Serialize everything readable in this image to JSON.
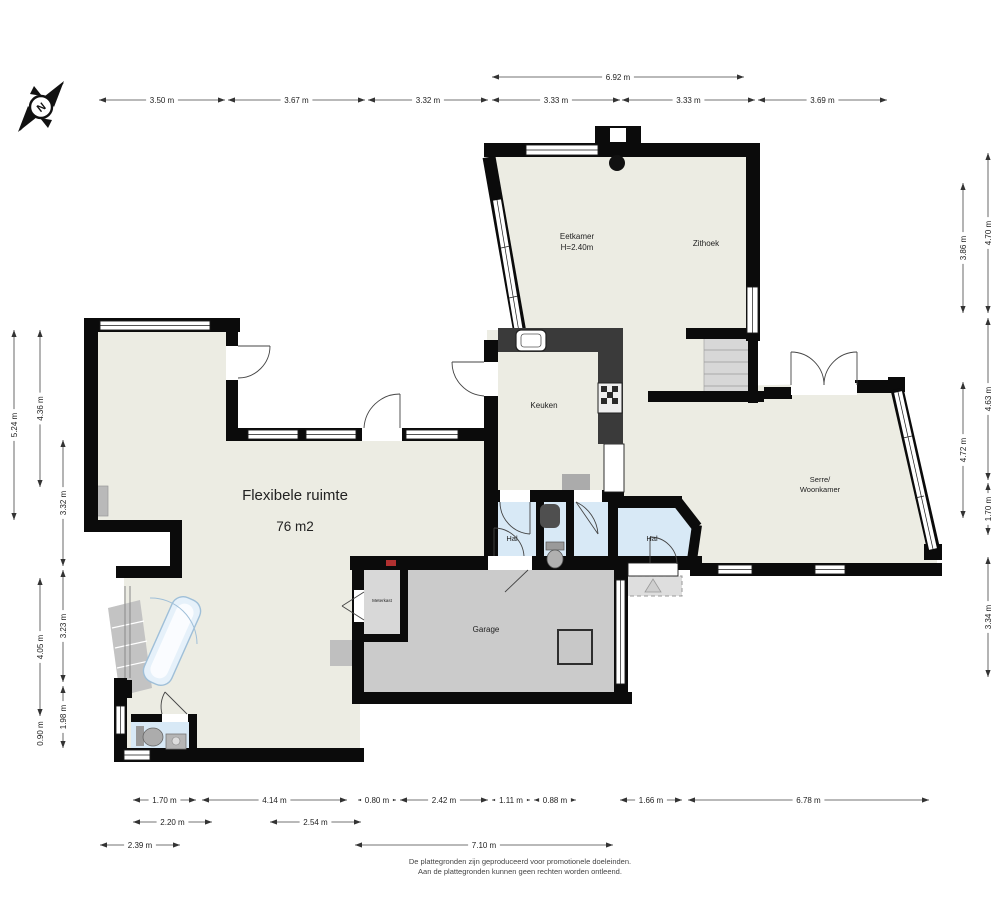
{
  "compass": {
    "label": "N"
  },
  "rooms": {
    "eetkamer": {
      "label": "Eetkamer",
      "height_note": "H=2.40m"
    },
    "zithoek": {
      "label": "Zithoek"
    },
    "keuken": {
      "label": "Keuken"
    },
    "serre": {
      "line1": "Serre/",
      "line2": "Woonkamer"
    },
    "flexibele": {
      "label": "Flexibele ruimte",
      "area": "76 m2"
    },
    "hal_left": {
      "label": "Hal"
    },
    "hal_right": {
      "label": "Hal"
    },
    "garage": {
      "label": "Garage"
    },
    "meterkast": {
      "label": "Meterkast"
    }
  },
  "colors": {
    "wall": "#0B0B0B",
    "floor": "#ECECE3",
    "garage_floor": "#CBCBCB",
    "hall_blue": "#D8E9F6",
    "counter_dark": "#3A3A3A",
    "dim_text": "#222222",
    "accent_red": "#B03030"
  },
  "dimensions": {
    "groups": [
      {
        "o": "h",
        "pos": 77,
        "items": [
          {
            "a": 492,
            "b": 744,
            "t": "6.92 m"
          }
        ]
      },
      {
        "o": "h",
        "pos": 100,
        "items": [
          {
            "a": 99,
            "b": 225,
            "t": "3.50 m"
          },
          {
            "a": 228,
            "b": 365,
            "t": "3.67 m"
          },
          {
            "a": 368,
            "b": 488,
            "t": "3.32 m"
          },
          {
            "a": 492,
            "b": 620,
            "t": "3.33 m"
          },
          {
            "a": 622,
            "b": 755,
            "t": "3.33 m"
          },
          {
            "a": 758,
            "b": 887,
            "t": "3.69 m"
          }
        ]
      },
      {
        "o": "h",
        "pos": 800,
        "items": [
          {
            "a": 133,
            "b": 196,
            "t": "1.70 m"
          },
          {
            "a": 202,
            "b": 347,
            "t": "4.14 m"
          },
          {
            "a": 358,
            "b": 396,
            "t": "0.80 m"
          },
          {
            "a": 400,
            "b": 488,
            "t": "2.42 m"
          },
          {
            "a": 492,
            "b": 530,
            "t": "1.11 m"
          },
          {
            "a": 534,
            "b": 576,
            "t": "0.88 m"
          },
          {
            "a": 620,
            "b": 682,
            "t": "1.66 m"
          },
          {
            "a": 688,
            "b": 929,
            "t": "6.78 m"
          }
        ]
      },
      {
        "o": "h",
        "pos": 822,
        "items": [
          {
            "a": 133,
            "b": 212,
            "t": "2.20 m"
          },
          {
            "a": 270,
            "b": 361,
            "t": "2.54 m"
          }
        ]
      },
      {
        "o": "h",
        "pos": 845,
        "items": [
          {
            "a": 100,
            "b": 180,
            "t": "2.39 m"
          },
          {
            "a": 355,
            "b": 613,
            "t": "7.10 m"
          }
        ]
      },
      {
        "o": "v",
        "pos": 14,
        "items": [
          {
            "a": 330,
            "b": 520,
            "t": "5.24 m"
          }
        ]
      },
      {
        "o": "v",
        "pos": 40,
        "items": [
          {
            "a": 330,
            "b": 487,
            "t": "4.36 m"
          },
          {
            "a": 578,
            "b": 716,
            "t": "4.05 m"
          },
          {
            "a": 719,
            "b": 748,
            "t": "0.90 m"
          }
        ]
      },
      {
        "o": "v",
        "pos": 63,
        "items": [
          {
            "a": 440,
            "b": 566,
            "t": "3.32 m"
          },
          {
            "a": 570,
            "b": 682,
            "t": "3.23 m"
          },
          {
            "a": 686,
            "b": 748,
            "t": "1.98 m"
          }
        ]
      },
      {
        "o": "v",
        "pos": 963,
        "items": [
          {
            "a": 183,
            "b": 313,
            "t": "3.86 m"
          },
          {
            "a": 382,
            "b": 518,
            "t": "4.72 m"
          }
        ]
      },
      {
        "o": "v",
        "pos": 988,
        "items": [
          {
            "a": 153,
            "b": 313,
            "t": "4.70 m"
          },
          {
            "a": 318,
            "b": 480,
            "t": "4.63 m"
          },
          {
            "a": 483,
            "b": 535,
            "t": "1.70 m"
          },
          {
            "a": 557,
            "b": 677,
            "t": "3.34 m"
          }
        ]
      }
    ]
  },
  "footer": {
    "line1": "De plattegronden zijn geproduceerd voor promotionele doeleinden.",
    "line2": "Aan de plattegronden kunnen geen rechten worden ontleend."
  }
}
